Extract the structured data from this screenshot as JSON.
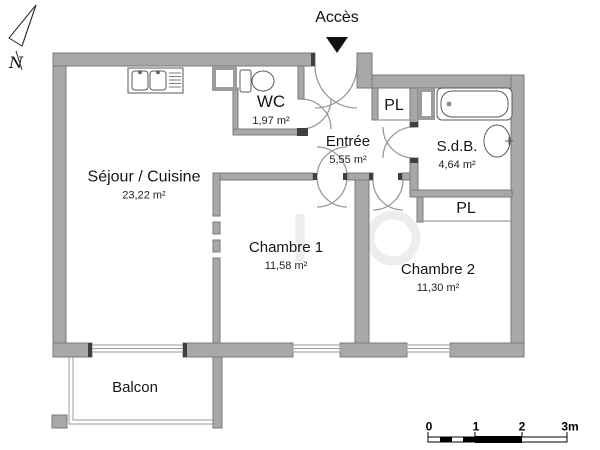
{
  "plan": {
    "access_label": "Accès",
    "north_label": "N",
    "rooms": [
      {
        "id": "sejour",
        "name": "Séjour / Cuisine",
        "area": "23,22 m²"
      },
      {
        "id": "wc",
        "name": "WC",
        "area": "1,97 m²"
      },
      {
        "id": "entree",
        "name": "Entrée",
        "area": "5,55 m²"
      },
      {
        "id": "sdb",
        "name": "S.d.B.",
        "area": "4,64 m²"
      },
      {
        "id": "chambre1",
        "name": "Chambre 1",
        "area": "11,58 m²"
      },
      {
        "id": "chambre2",
        "name": "Chambre 2",
        "area": "11,30 m²"
      },
      {
        "id": "balcon",
        "name": "Balcon",
        "area": ""
      }
    ],
    "closets": [
      {
        "label": "PL"
      },
      {
        "label": "PL"
      }
    ],
    "fixtures": [
      "kitchen-sink",
      "toilet",
      "bathtub",
      "washbasin"
    ],
    "colors": {
      "wall": "#a8a8a8",
      "wall_outline": "#7a7a7a",
      "door_arc": "#9a9a9a",
      "jamb": "#3f3f3f",
      "text": "#111111"
    }
  },
  "scale_bar": {
    "tick_labels": [
      "0",
      "1",
      "2",
      "3m"
    ]
  }
}
